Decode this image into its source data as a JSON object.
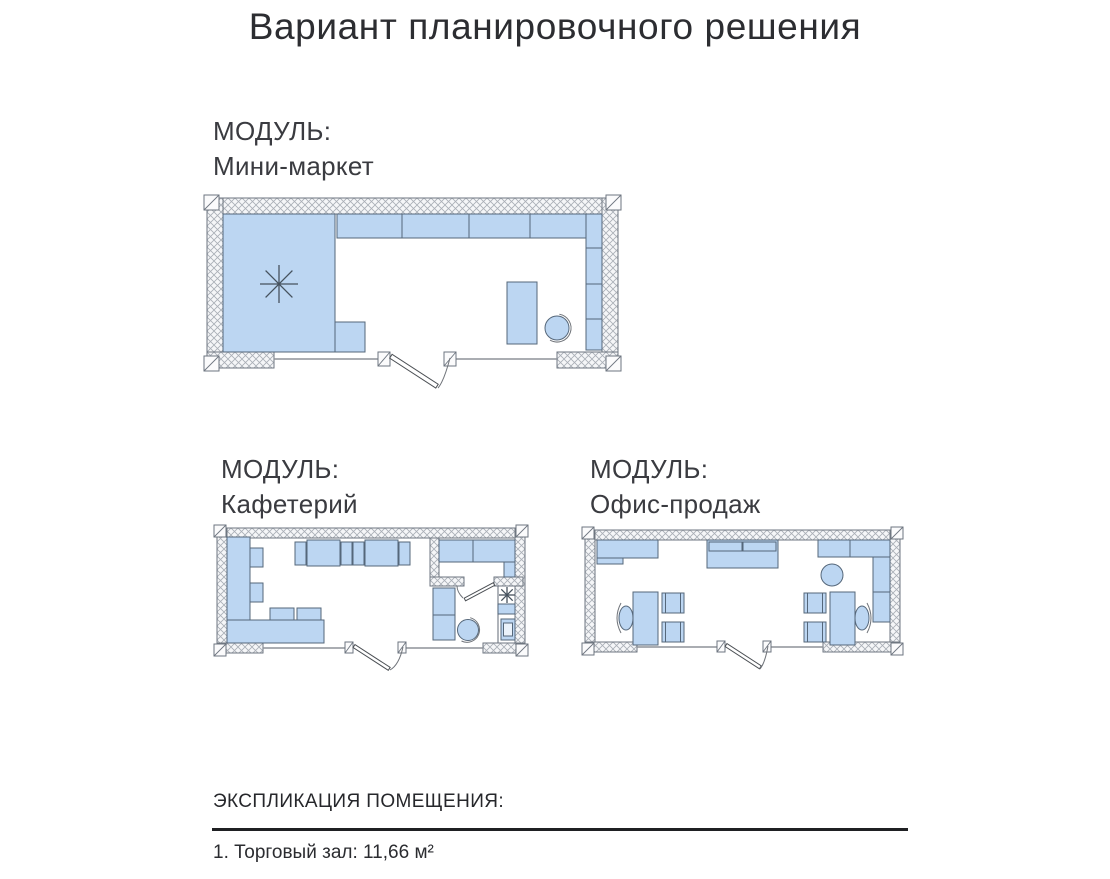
{
  "page": {
    "title": "Вариант планировочного решения"
  },
  "modules": [
    {
      "id": "mini-market",
      "label_prefix": "МОДУЛЬ:",
      "name": "Мини-маркет"
    },
    {
      "id": "cafeteria",
      "label_prefix": "МОДУЛЬ:",
      "name": "Кафетерий"
    },
    {
      "id": "sales-office",
      "label_prefix": "МОДУЛЬ:",
      "name": "Офис-продаж"
    }
  ],
  "explication": {
    "heading": "ЭКСПЛИКАЦИЯ ПОМЕЩЕНИЯ:",
    "items": [
      "1. Торговый зал: 11,66 м²"
    ]
  },
  "icons": {
    "ceiling_light_symbol": "eight-spoke asterisk",
    "door_symbol": "leaf with quarter-arc swing"
  },
  "theme": {
    "furniture_fill": "#BCD6F2",
    "furniture_stroke": "#55677A",
    "wall_line": "#6E7680",
    "hatch_line": "#A9AEB6",
    "hatch_fill": "#F5F6F8",
    "thin_line": "#8D9298",
    "door_line": "#4B4F54",
    "symbol_line": "#46525E",
    "text_dark": "#2C2D31",
    "text_medium": "#3A3B40",
    "rule_color": "#1F2023",
    "page_bg": "#FFFFFF"
  }
}
